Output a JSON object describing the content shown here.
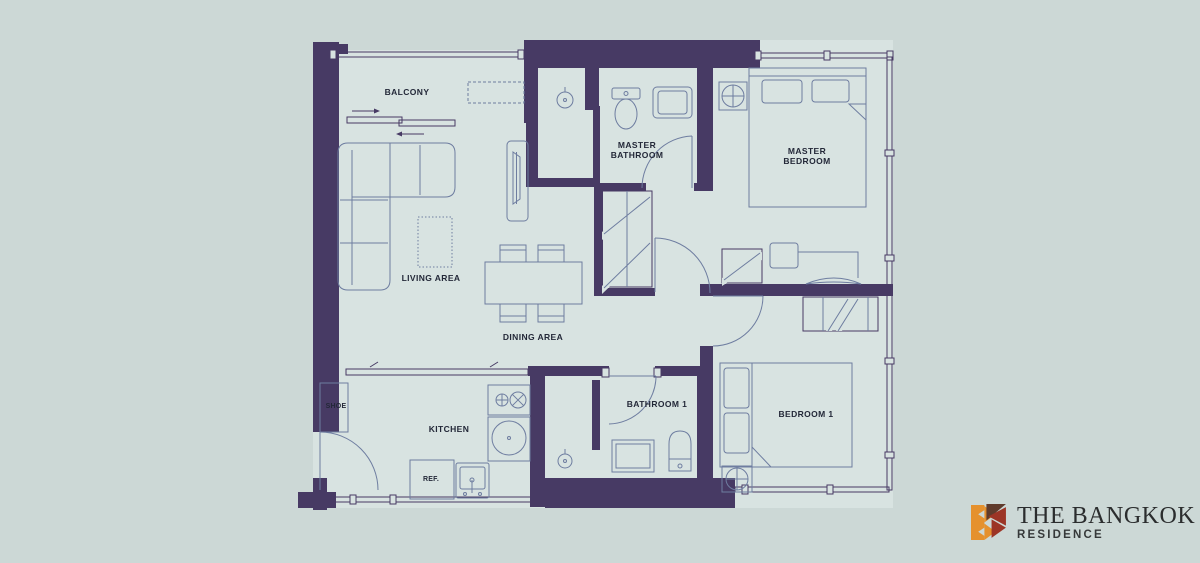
{
  "colors": {
    "background": "#ccd8d6",
    "floor": "#d8e3e1",
    "wall": "#473a64",
    "furniture_line": "#6e7da0",
    "text": "#232838",
    "logo_orange": "#e5912d",
    "logo_maroon": "#9c3526",
    "logo_brown": "#5f3b2c",
    "logo_text": "#2b2d2e",
    "logo_subtext": "#36393a"
  },
  "floorplan": {
    "rooms": [
      {
        "id": "balcony",
        "label": "BALCONY"
      },
      {
        "id": "master_bathroom",
        "label": "MASTER BATHROOM",
        "line1": "MASTER",
        "line2": "BATHROOM"
      },
      {
        "id": "master_bedroom",
        "label": "MASTER BEDROOM",
        "line1": "MASTER",
        "line2": "BEDROOM"
      },
      {
        "id": "living_area",
        "label": "LIVING AREA"
      },
      {
        "id": "dining_area",
        "label": "DINING AREA"
      },
      {
        "id": "shoe",
        "label": "SHOE"
      },
      {
        "id": "kitchen",
        "label": "KITCHEN"
      },
      {
        "id": "refrigerator",
        "label": "REF."
      },
      {
        "id": "bathroom_1",
        "label": "BATHROOM 1"
      },
      {
        "id": "bedroom_1",
        "label": "BEDROOM 1"
      }
    ],
    "symbols": [
      "door-swing-arc",
      "window-line",
      "wardrobe-hatch",
      "ceiling-fixture-cross-circle",
      "shower-head",
      "stove-burners",
      "sink",
      "toilet",
      "bed",
      "sofa",
      "dining-set",
      "ac-unit-dashed"
    ]
  },
  "logo": {
    "title": "THE BANGKOK",
    "subtitle": "RESIDENCE"
  }
}
